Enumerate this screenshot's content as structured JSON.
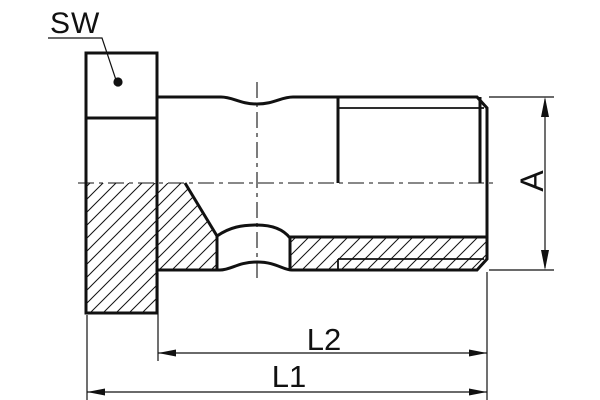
{
  "drawing": {
    "colors": {
      "line": "#111111",
      "background": "#ffffff"
    },
    "labels": {
      "across_flats": "SW",
      "diameter": "A",
      "length_inner": "L2",
      "length_overall": "L1"
    }
  }
}
